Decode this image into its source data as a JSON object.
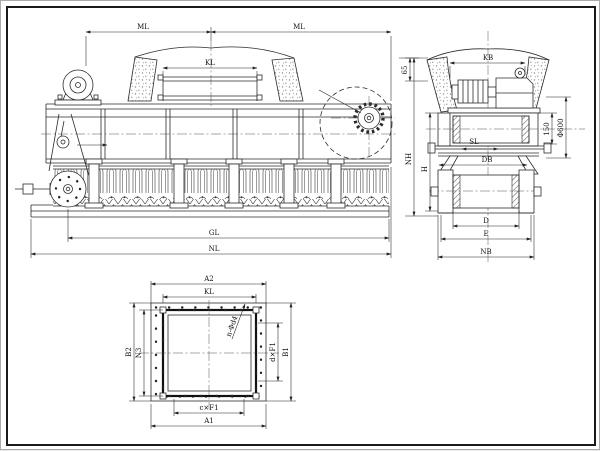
{
  "front_view": {
    "labels": {
      "ml_left": "ML",
      "ml_right": "ML",
      "kl": "KL",
      "gl": "GL",
      "nl": "NL"
    }
  },
  "side_view": {
    "labels": {
      "kb": "KB",
      "wall": "65",
      "nh": "NH",
      "h": "H",
      "offset": "150",
      "drum_dia": "Φ600",
      "sl": "SL",
      "db": "DB",
      "d": "D",
      "e": "E",
      "nb": "NB"
    }
  },
  "plan_view": {
    "labels": {
      "a2": "A2",
      "kl": "KL",
      "b2": "B2",
      "n3": "N3",
      "b1": "B1",
      "dxf1": "d×F1",
      "cxf1": "c×F1",
      "a1": "A1",
      "hole_callout": "n-Φd4"
    }
  }
}
